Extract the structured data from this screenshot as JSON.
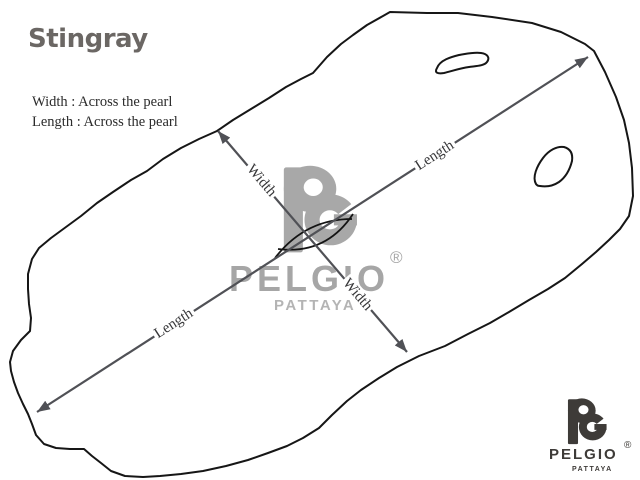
{
  "header": {
    "title": "Stingray",
    "definitions": [
      "Width : Across the pearl",
      "Length : Across the pearl"
    ]
  },
  "diagram": {
    "measure_labels": {
      "width": "Width",
      "length": "Length"
    },
    "outline_color": "#161616",
    "arrow_color": "#505156"
  },
  "watermark": {
    "monogram": "PG",
    "brand": "PELGIO",
    "registered_symbol": "®",
    "city": "PATTAYA",
    "color": "#a8a8a8"
  },
  "brand_logo": {
    "monogram": "PG",
    "brand": "PELGIO",
    "registered_symbol": "®",
    "city": "PATTAYA",
    "color": "#3e3b38"
  }
}
